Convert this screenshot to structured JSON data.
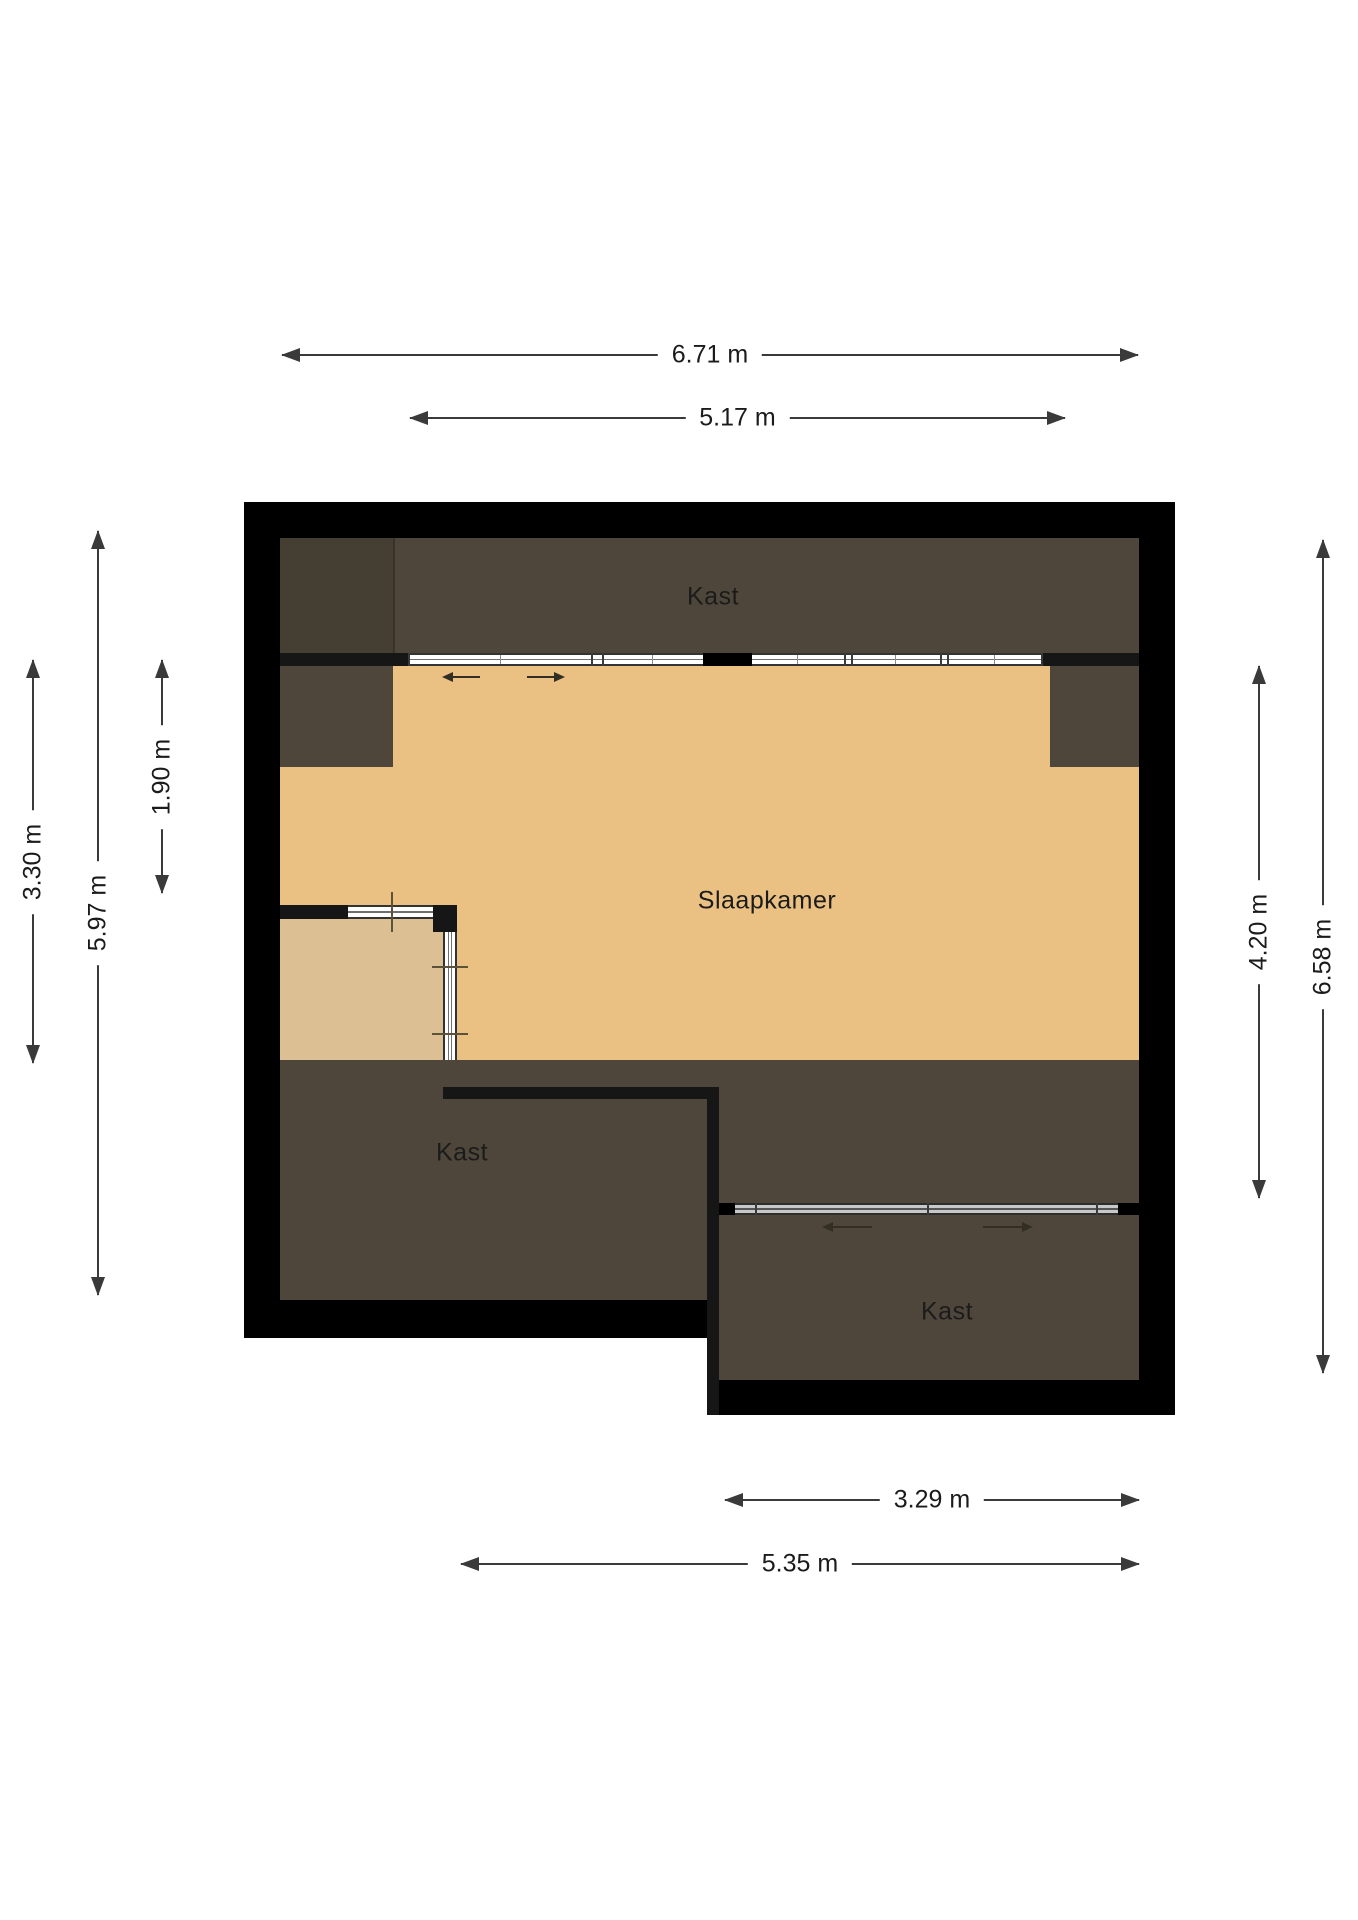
{
  "rooms": {
    "top_closet": "Kast",
    "bedroom": "Slaapkamer",
    "bottom_left_closet": "Kast",
    "bottom_right_closet": "Kast"
  },
  "dimensions": {
    "top_outer": "6.71 m",
    "top_inner": "5.17 m",
    "left_room_depth": "3.30 m",
    "left_outer_height": "5.97 m",
    "left_upper_depth": "1.90 m",
    "right_room_depth": "4.20 m",
    "right_outer_height": "6.58 m",
    "bottom_closet_width": "3.29 m",
    "bottom_span_width": "5.35 m"
  },
  "colors": {
    "wall": "#000000",
    "wall-interior": "#161616",
    "closet-dark": "#4e463a",
    "closet-darker": "#453f33",
    "floor-tan": "#eac182",
    "floor-tan-light": "#dcc094",
    "dimension-line": "#3a3a3a",
    "label-text": "#1b1b1b",
    "glass-white": "#ffffff",
    "glass-gray": "#c7c8c9",
    "window-frame": "#333333"
  }
}
